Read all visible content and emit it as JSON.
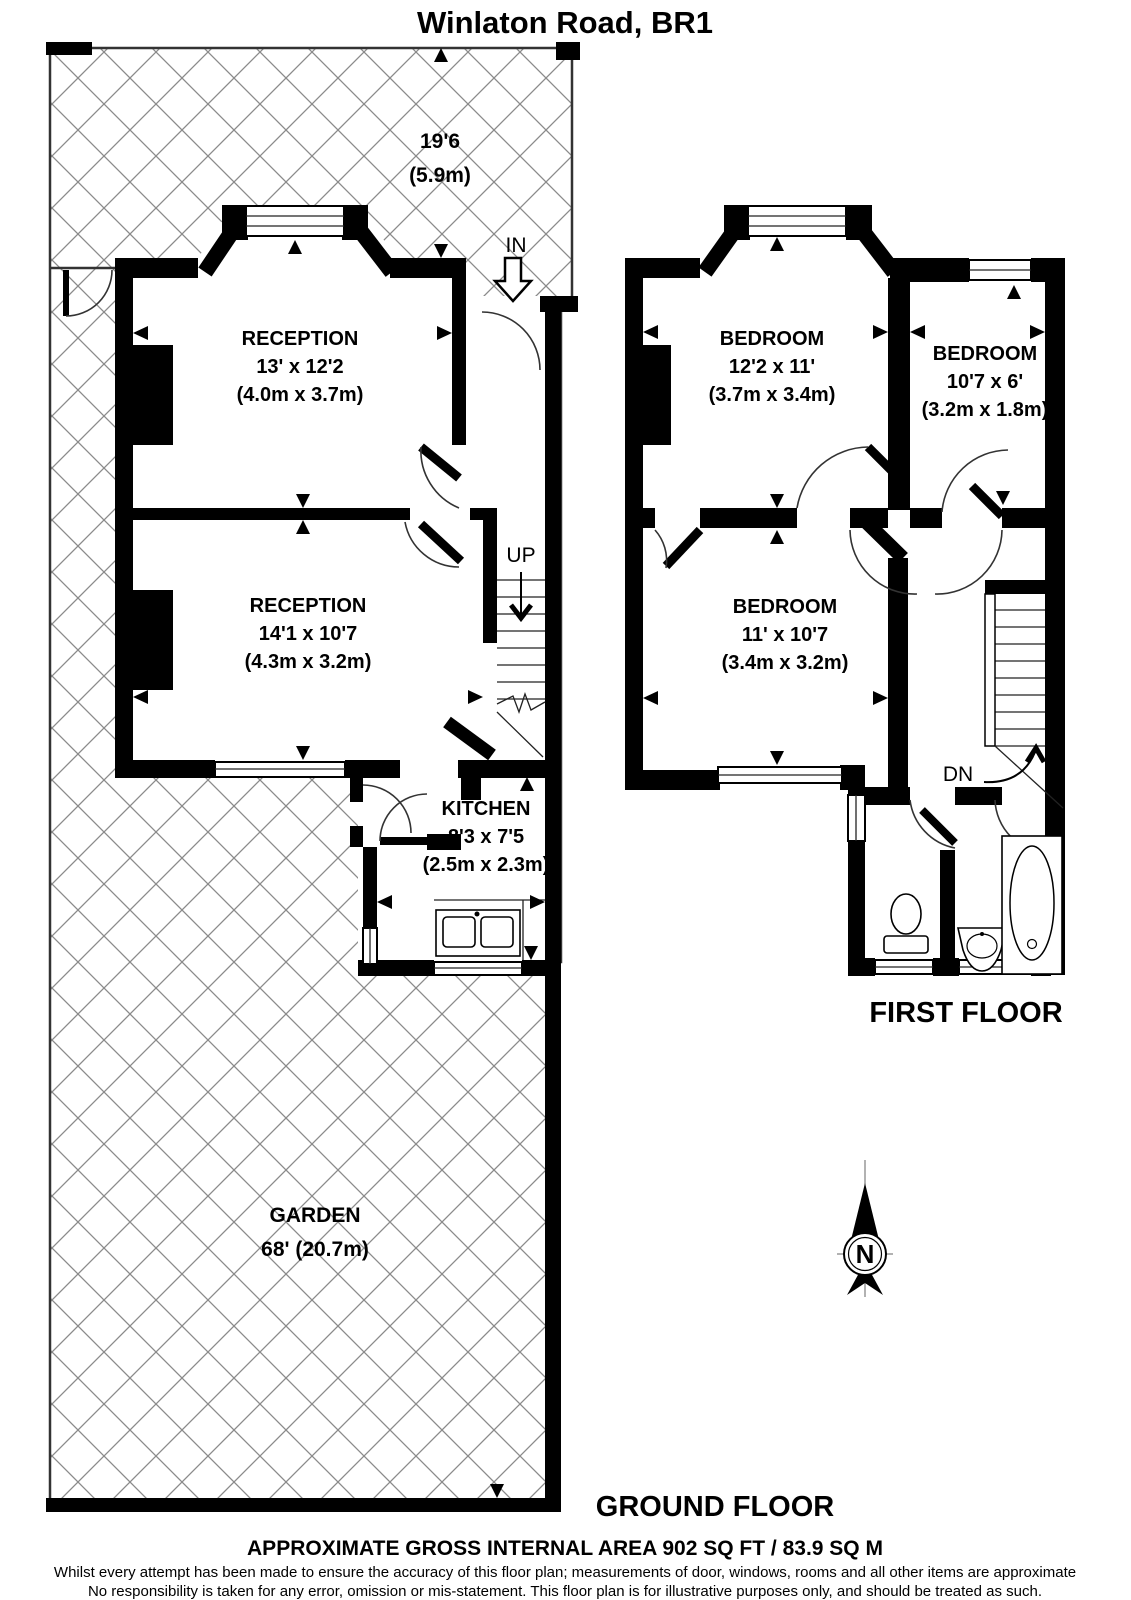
{
  "title": "Winlaton Road, BR1",
  "ground_floor": {
    "label": "GROUND FLOOR",
    "garden": {
      "name": "GARDEN",
      "length": "68' (20.7m)",
      "depth_ft": "19'6",
      "depth_m": "(5.9m)"
    },
    "reception1": {
      "name": "RECEPTION",
      "size_ft": "13' x 12'2",
      "size_m": "(4.0m x 3.7m)"
    },
    "reception2": {
      "name": "RECEPTION",
      "size_ft": "14'1 x 10'7",
      "size_m": "(4.3m x 3.2m)"
    },
    "kitchen": {
      "name": "KITCHEN",
      "size_ft": "8'3 x 7'5",
      "size_m": "(2.5m x 2.3m)"
    },
    "entrance_label": "IN",
    "stairs_label": "UP"
  },
  "first_floor": {
    "label": "FIRST FLOOR",
    "bedroom1": {
      "name": "BEDROOM",
      "size_ft": "12'2 x 11'",
      "size_m": "(3.7m x 3.4m)"
    },
    "bedroom2": {
      "name": "BEDROOM",
      "size_ft": "10'7 x 6'",
      "size_m": "(3.2m x 1.8m)"
    },
    "bedroom3": {
      "name": "BEDROOM",
      "size_ft": "11' x 10'7",
      "size_m": "(3.4m x 3.2m)"
    },
    "stairs_label": "DN"
  },
  "compass": {
    "north_label": "N"
  },
  "footer": {
    "area_note": "APPROXIMATE GROSS INTERNAL AREA 902 SQ FT / 83.9 SQ M",
    "disclaimer_line1": "Whilst every attempt has been made to ensure the accuracy of this floor plan; measurements of door, windows, rooms and all other items are approximate",
    "disclaimer_line2": "No responsibility is taken for any error, omission or mis-statement. This floor plan is for illustrative purposes only, and should be treated as such."
  },
  "colors": {
    "wall": "#000000",
    "hatch_line": "#8a8a8a",
    "background": "#ffffff"
  }
}
